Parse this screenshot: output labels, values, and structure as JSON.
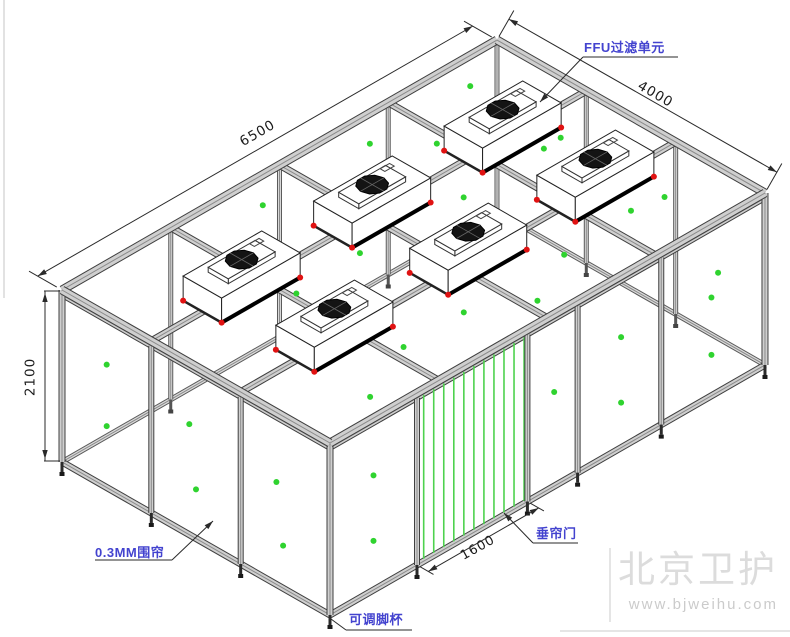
{
  "drawing": {
    "labels": {
      "ffu_unit": "FFU过滤单元",
      "curtain": "0.3MM围帘",
      "door": "垂帘门",
      "foot": "可调脚杯"
    },
    "dimensions": {
      "length": "6500",
      "width": "4000",
      "height": "2100",
      "door_width": "1600"
    },
    "watermark": {
      "name": "北京卫护",
      "url": "www.bjweihu.com"
    },
    "colors": {
      "beam_fill": "#cfcfcf",
      "beam_edge": "#3f3f3f",
      "beam_groove": "#8a8a8a",
      "back_fill": "#dadada",
      "back_edge": "#5a5a5a",
      "green_dot": "#2fd32f",
      "door_strip": "#4ed24e",
      "red_marker": "#e01212",
      "fan_dark": "#141414",
      "dim_line": "#2a2a2a",
      "label_blue": "#4343cf",
      "watermark_gray": "#dcdcdc"
    },
    "structure": {
      "iso": {
        "ox": 62,
        "oy": 290,
        "ux": 0.06692,
        "uy": -0.03846,
        "vx": 0.067,
        "vy": 0.03825,
        "zs": 0.0819,
        "roof_z": 2100,
        "rail_z": 2040,
        "L": 6500,
        "W": 4000,
        "H": 2100
      },
      "grid": {
        "u_lines": [
          1625,
          3250,
          4875
        ],
        "v_lines": [
          1333,
          2667
        ]
      },
      "walls": {
        "front_posts_a": [
          1300,
          2950,
          3700,
          4950
        ],
        "left_posts_b": [
          1333,
          2667
        ],
        "back_top_posts_a": [
          1625,
          3250,
          4875
        ],
        "back_right_posts_b": [
          1333,
          2667
        ]
      },
      "door": {
        "a1": 1300,
        "a2": 2950,
        "strip_a0": 1400,
        "strip_step": 150,
        "strips": 11
      },
      "ffus": [
        {
          "a": 1350,
          "b": 1333
        },
        {
          "a": 3300,
          "b": 1333
        },
        {
          "a": 5250,
          "b": 1333
        },
        {
          "a": 1400,
          "b": 2667
        },
        {
          "a": 3400,
          "b": 2667
        },
        {
          "a": 5300,
          "b": 2667
        }
      ],
      "ffu_size": {
        "half_len": 587,
        "half_wid": 287,
        "h": 300,
        "slab_hl": 350,
        "slab_hw": 150,
        "slab_h": 60,
        "fan_r": 175
      },
      "dots": {
        "roof": [
          [
            2600,
            400
          ],
          [
            4200,
            400
          ],
          [
            5700,
            400
          ],
          [
            900,
            1000
          ],
          [
            3300,
            950
          ],
          [
            4700,
            900
          ],
          [
            6100,
            900
          ],
          [
            1700,
            1800
          ],
          [
            2700,
            1750
          ],
          [
            4200,
            1800
          ],
          [
            5700,
            1750
          ],
          [
            900,
            2400
          ],
          [
            3300,
            2350
          ],
          [
            4800,
            2400
          ],
          [
            6100,
            2350
          ],
          [
            1800,
            3300
          ],
          [
            2700,
            3300
          ],
          [
            4200,
            3300
          ],
          [
            5700,
            3300
          ],
          [
            900,
            3700
          ],
          [
            3400,
            3700
          ]
        ],
        "left_wall": [
          [
            667,
            1500
          ],
          [
            667,
            750
          ],
          [
            1900,
            1350
          ],
          [
            2000,
            600
          ],
          [
            3200,
            1250
          ],
          [
            3300,
            520
          ]
        ],
        "front_wall": [
          [
            650,
            1400
          ],
          [
            650,
            600
          ],
          [
            3350,
            1150
          ],
          [
            4350,
            1350
          ],
          [
            4350,
            550
          ],
          [
            5700,
            1200
          ],
          [
            5700,
            500
          ]
        ],
        "back_right_wall": [
          [
            700,
            1100
          ],
          [
            2000,
            950
          ],
          [
            3300,
            800
          ]
        ]
      }
    }
  }
}
